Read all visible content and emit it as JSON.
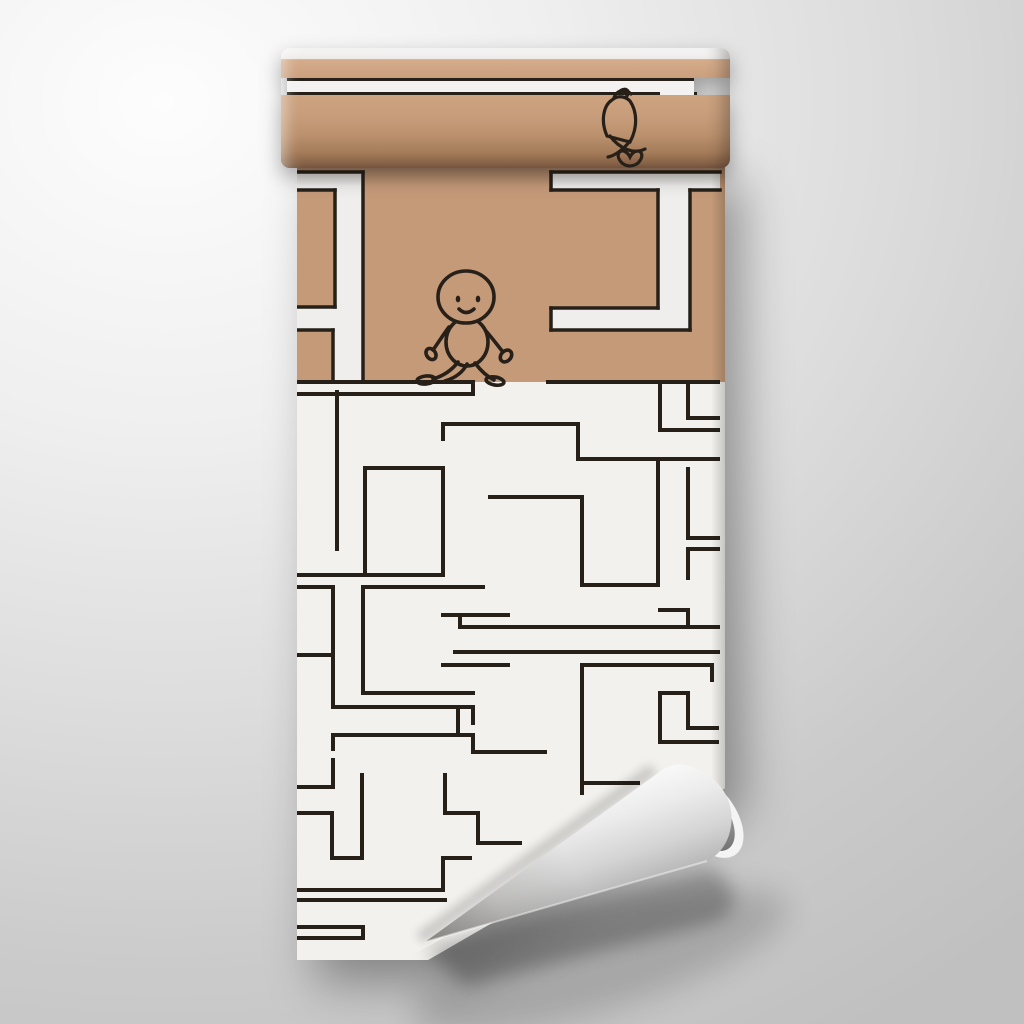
{
  "scene": {
    "description": "Product mockup of a partially unrolled wallpaper roll hanging on a wall. The printed design is a rectilinear maze: the top kraft-tan section shows wide white maze corridors outlined in black with a smiling hand-drawn character walking through a gap, plus a sketchy doodle figure near the rolled top; the lower section is off-white with a dense thin-line black maze. The bottom-right corner of the sheet curls up in a cone shape revealing the gray paper back.",
    "colors": {
      "wall_light": "#fdfdfd",
      "wall_dark": "#c0c0c0",
      "kraft_tan": "#c59a79",
      "kraft_tan_light": "#d2a886",
      "kraft_tan_dark": "#8a6448",
      "paper_white": "#f2f1ee",
      "path_white": "#efeeec",
      "ink": "#262019",
      "curl_back_light": "#f5f5f5",
      "curl_back_dark": "#8f8f8f"
    }
  },
  "tan_section": {
    "height": 222,
    "top_shade_height": 26,
    "white_rects": [
      {
        "x": 0,
        "y": 12,
        "w": 66,
        "h": 209
      },
      {
        "x": 254,
        "y": 12,
        "w": 169,
        "h": 18
      },
      {
        "x": 361,
        "y": 30,
        "w": 32,
        "h": 118
      },
      {
        "x": 254,
        "y": 148,
        "w": 139,
        "h": 22
      }
    ],
    "tan_holes": [
      {
        "x": 0,
        "y": 30,
        "w": 38,
        "h": 117
      },
      {
        "x": 0,
        "y": 170,
        "w": 36,
        "h": 51
      }
    ],
    "outline_segments": [
      [
        0,
        12,
        66,
        12
      ],
      [
        66,
        12,
        66,
        221
      ],
      [
        0,
        30,
        38,
        30
      ],
      [
        38,
        30,
        38,
        147
      ],
      [
        0,
        147,
        38,
        147
      ],
      [
        0,
        170,
        36,
        170
      ],
      [
        36,
        170,
        36,
        221
      ],
      [
        254,
        12,
        423,
        12
      ],
      [
        254,
        12,
        254,
        30
      ],
      [
        254,
        30,
        361,
        30
      ],
      [
        393,
        30,
        423,
        30
      ],
      [
        361,
        30,
        361,
        148
      ],
      [
        393,
        30,
        393,
        170
      ],
      [
        254,
        148,
        361,
        148
      ],
      [
        254,
        148,
        254,
        170
      ],
      [
        254,
        170,
        393,
        170
      ]
    ],
    "boundary_segments": [
      [
        0,
        222,
        176,
        222
      ],
      [
        251,
        222,
        421,
        222
      ],
      [
        0,
        234,
        176,
        234
      ],
      [
        176,
        222,
        176,
        234
      ]
    ]
  },
  "maze": {
    "stroke_width": 4,
    "segments": [
      [
        40,
        232,
        40,
        389
      ],
      [
        146,
        264,
        281,
        264
      ],
      [
        146,
        264,
        146,
        279
      ],
      [
        281,
        264,
        281,
        299
      ],
      [
        281,
        299,
        421,
        299
      ],
      [
        363,
        222,
        363,
        270
      ],
      [
        363,
        270,
        421,
        270
      ],
      [
        391,
        222,
        391,
        258
      ],
      [
        391,
        258,
        421,
        258
      ],
      [
        361,
        299,
        361,
        425
      ],
      [
        285,
        425,
        361,
        425
      ],
      [
        285,
        337,
        285,
        425
      ],
      [
        193,
        337,
        285,
        337
      ],
      [
        391,
        309,
        391,
        378
      ],
      [
        391,
        378,
        421,
        378
      ],
      [
        391,
        389,
        421,
        389
      ],
      [
        391,
        389,
        391,
        418
      ],
      [
        0,
        415,
        146,
        415
      ],
      [
        146,
        308,
        146,
        415
      ],
      [
        68,
        308,
        146,
        308
      ],
      [
        68,
        308,
        68,
        415
      ],
      [
        66,
        427,
        66,
        533
      ],
      [
        66,
        427,
        186,
        427
      ],
      [
        146,
        455,
        211,
        455
      ],
      [
        146,
        505,
        211,
        505
      ],
      [
        0,
        427,
        36,
        427
      ],
      [
        36,
        427,
        36,
        547
      ],
      [
        0,
        495,
        36,
        495
      ],
      [
        36,
        547,
        176,
        547
      ],
      [
        66,
        533,
        176,
        533
      ],
      [
        363,
        450,
        391,
        450
      ],
      [
        391,
        450,
        391,
        465
      ],
      [
        163,
        467,
        421,
        467
      ],
      [
        163,
        455,
        163,
        467
      ],
      [
        158,
        492,
        421,
        492
      ],
      [
        285,
        505,
        285,
        633
      ],
      [
        285,
        505,
        415,
        505
      ],
      [
        415,
        505,
        415,
        520
      ],
      [
        363,
        533,
        391,
        533
      ],
      [
        363,
        533,
        363,
        582
      ],
      [
        363,
        582,
        420,
        582
      ],
      [
        391,
        533,
        391,
        568
      ],
      [
        391,
        568,
        420,
        568
      ],
      [
        285,
        623,
        341,
        623
      ],
      [
        176,
        547,
        176,
        563
      ],
      [
        36,
        575,
        176,
        575
      ],
      [
        36,
        575,
        36,
        589
      ],
      [
        176,
        575,
        176,
        592
      ],
      [
        176,
        592,
        248,
        592
      ],
      [
        161,
        547,
        161,
        575
      ],
      [
        0,
        627,
        36,
        627
      ],
      [
        36,
        600,
        36,
        627
      ],
      [
        65,
        615,
        65,
        698
      ],
      [
        35,
        698,
        65,
        698
      ],
      [
        35,
        653,
        35,
        698
      ],
      [
        0,
        653,
        35,
        653
      ],
      [
        0,
        730,
        146,
        730
      ],
      [
        0,
        740,
        148,
        740
      ],
      [
        146,
        698,
        146,
        730
      ],
      [
        146,
        698,
        173,
        698
      ],
      [
        0,
        767,
        66,
        767
      ],
      [
        0,
        778,
        66,
        778
      ],
      [
        66,
        767,
        66,
        778
      ],
      [
        148,
        615,
        148,
        653
      ],
      [
        148,
        653,
        181,
        653
      ],
      [
        181,
        653,
        181,
        683
      ],
      [
        181,
        683,
        223,
        683
      ]
    ]
  },
  "characters": {
    "walking_figure": {
      "label": "smiling walking doodle character",
      "stroke_width": 3.6,
      "head": {
        "cx": 169,
        "cy": 137,
        "rx": 28,
        "ry": 26
      },
      "eyes": [
        {
          "cx": 161,
          "cy": 139,
          "rx": 2.3,
          "ry": 3.4
        },
        {
          "cx": 181,
          "cy": 139,
          "rx": 2.3,
          "ry": 3.4
        }
      ],
      "smile": "M162,149 Q169,156 177,149",
      "body": {
        "cx": 170,
        "cy": 182,
        "rx": 21,
        "ry": 24
      },
      "limbs": [
        "M152,167 C146,175 141,183 136,190",
        "M189,171 C196,179 201,186 206,192",
        "M161,202 C155,210 146,216 136,219",
        "M170,204 C166,212 158,218 148,221",
        "M178,203 C184,211 191,217 197,220"
      ],
      "loops": [
        {
          "cx": 134,
          "cy": 194,
          "rx": 4.5,
          "ry": 6,
          "rot": -35
        },
        {
          "cx": 209,
          "cy": 196,
          "rx": 5,
          "ry": 6.5,
          "rot": 42
        },
        {
          "cx": 129,
          "cy": 220,
          "rx": 9,
          "ry": 4,
          "rot": -6
        },
        {
          "cx": 198,
          "cy": 221,
          "rx": 9,
          "ry": 4,
          "rot": 10
        }
      ]
    },
    "doodle_figure": {
      "label": "sketchy scribble figure emerging from the roll",
      "stroke_width": 3.2,
      "paths": [
        "M27,15 C19,20 15,35 22,51 L45,57 C52,44 53,28 45,16 C39,10 31,11 27,15",
        "M25,51 C34,63 48,70 60,64",
        "M45,56 C38,65 29,71 23,72",
        "M37,78 C27,68 39,60 45,72 C51,60 63,68 53,78 C48,82 42,82 37,78",
        "M29,13 C31,5 41,3 46,9",
        "M34,7 C40,1 47,6 41,12"
      ]
    }
  }
}
